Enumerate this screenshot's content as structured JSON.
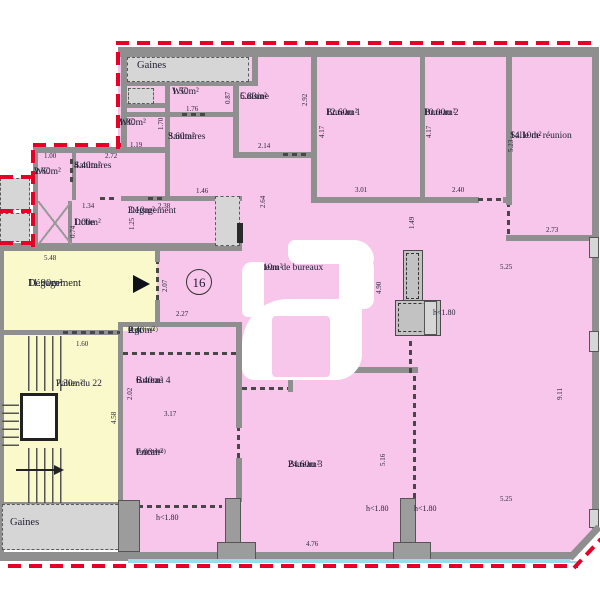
{
  "title": "Floor plan - Plateau de bureaux lot 16",
  "rooms": {
    "gaines_top": {
      "name": "Gaines"
    },
    "wc_150": {
      "name": "WC",
      "area": "1.50m²"
    },
    "sanitaires_360": {
      "name": "Sanitaires",
      "area": "3.60m²"
    },
    "wc_180": {
      "name": "WC",
      "area": "1.80m²"
    },
    "cuisine": {
      "name": "Cuisine",
      "area": "5.80m²"
    },
    "bureau_1": {
      "name": "Bureau 1",
      "area": "12.60m²"
    },
    "bureau_2": {
      "name": "Bureau 2",
      "area": "10.00m²"
    },
    "salle_reunion": {
      "name": "Salle de réunion",
      "area": "14.10m²"
    },
    "wc_260": {
      "name": "WC",
      "area": "2.60m²"
    },
    "sanitaires_440": {
      "name": "Sanitaires",
      "area": "4.40m²"
    },
    "dche": {
      "name": "Dche",
      "area": "1.00m²"
    },
    "degagement_310": {
      "name": "Dégagement",
      "area": "3.10m²"
    },
    "degagement_1190": {
      "name": "Dégagement",
      "area": "11.90m²"
    },
    "plateau": {
      "name": "Plateau de bureaux",
      "area": "82.10m²"
    },
    "rgt": {
      "name": "Rgt",
      "note": "(non visité)",
      "area": "2.40m²"
    },
    "bureau_4": {
      "name": "Bureau 4",
      "area": "6.40m²"
    },
    "local": {
      "name": "Local",
      "note": "(non visité)",
      "area": "7.00m²"
    },
    "bureau_3": {
      "name": "Bureau 3",
      "area": "24.60m²"
    },
    "palier": {
      "name": "Palier du 22",
      "area": "7.30m²"
    },
    "gaines_bottom": {
      "name": "Gaines"
    }
  },
  "marker": {
    "unit_number": "16"
  },
  "height_note": "h<1.80",
  "dims": {
    "a": "1.00",
    "b": "2.72",
    "c": "1.34",
    "d": "0.74",
    "e": "1.19",
    "f": "1.76",
    "g": "0.87",
    "h": "1.70",
    "i": "2.14",
    "j": "2.92",
    "k": "4.17",
    "l": "3.01",
    "m": "2.40",
    "n": "5.23",
    "o": "2.73",
    "p": "1.46",
    "q": "2.38",
    "r": "1.25",
    "s": "2.64",
    "t": "5.48",
    "u": "2.07",
    "v": "2.27",
    "w": "1.60",
    "x": "2.02",
    "y": "3.17",
    "z": "4.58",
    "aa": "1.49",
    "ab": "4.90",
    "ac": "5.25",
    "ad": "3.51",
    "ae": "9.11",
    "af": "5.16",
    "ag": "4.76"
  },
  "colors": {
    "room_pink": "#f8c6ea",
    "common_yellow": "#f9f9cb",
    "wall_gray": "#8f8f8f",
    "shaft_gray": "#d6d6d6",
    "property_red": "#e60026",
    "frontage_cyan": "#9adcee"
  }
}
